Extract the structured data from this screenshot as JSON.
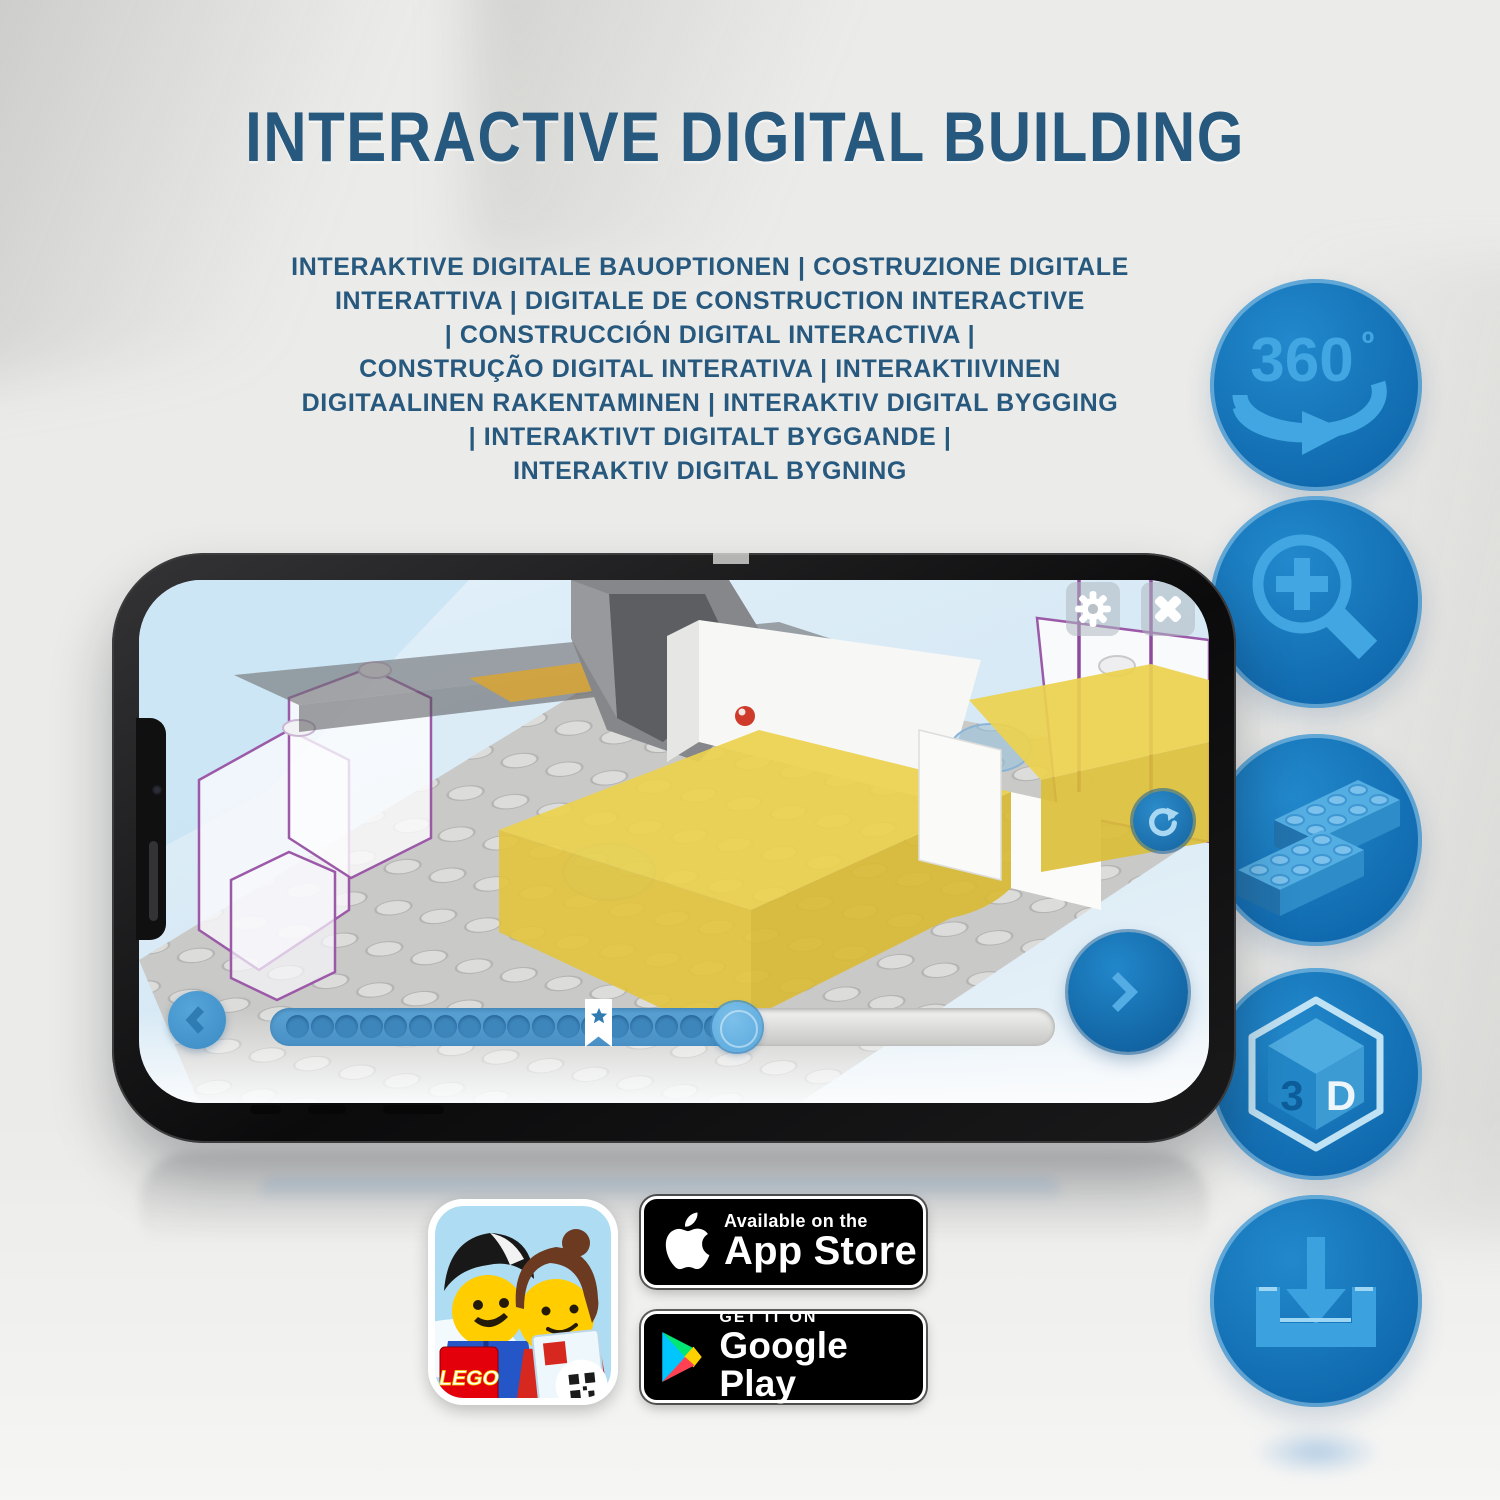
{
  "title": "INTERACTIVE DIGITAL BUILDING",
  "subtitle": {
    "lines": [
      "INTERAKTIVE DIGITALE BAUOPTIONEN | COSTRUZIONE DIGITALE",
      "INTERATTIVA | DIGITALE DE CONSTRUCTION INTERACTIVE",
      "| CONSTRUCCIÓN DIGITAL INTERACTIVA |",
      "CONSTRUÇÃO DIGITAL INTERATIVA | INTERAKTIIVINEN",
      "DIGITAALINEN RAKENTAMINEN | INTERAKTIV DIGITAL BYGGING",
      "| INTERAKTIVT DIGITALT BYGGANDE |",
      "INTERAKTIV DIGITAL BYGNING"
    ]
  },
  "feature_icons": {
    "rotate_360": {
      "text": "360",
      "degree": "º"
    },
    "cube_3d": {
      "left_face": "3",
      "right_face": "D"
    },
    "names": [
      "360-rotation",
      "zoom-in-magnifier",
      "lego-bricks",
      "3d-cube",
      "download"
    ]
  },
  "phone_app": {
    "progress": {
      "dot_count": 19,
      "percent_filled": 62,
      "star_marker": true
    }
  },
  "store_badges": {
    "lego_app": {
      "logo_text": "LEGO"
    },
    "app_store": {
      "line1": "Available on the",
      "line2": "App Store"
    },
    "google_play": {
      "line1": "GET IT ON",
      "line2": "Google Play"
    }
  },
  "colors": {
    "heading_blue": "#27587E",
    "icon_circle_fill": "#1478BE",
    "icon_circle_rim": "#8FC2E2",
    "icon_glyph_blue": "#41A6E1",
    "screen_sky": "#D8EAF6",
    "progress_fill": "#4E98CD",
    "yellow_brick": "#ECD14E",
    "purple_outline": "#9B59A8",
    "badge_black": "#000000",
    "lego_red": "#E3000B"
  }
}
